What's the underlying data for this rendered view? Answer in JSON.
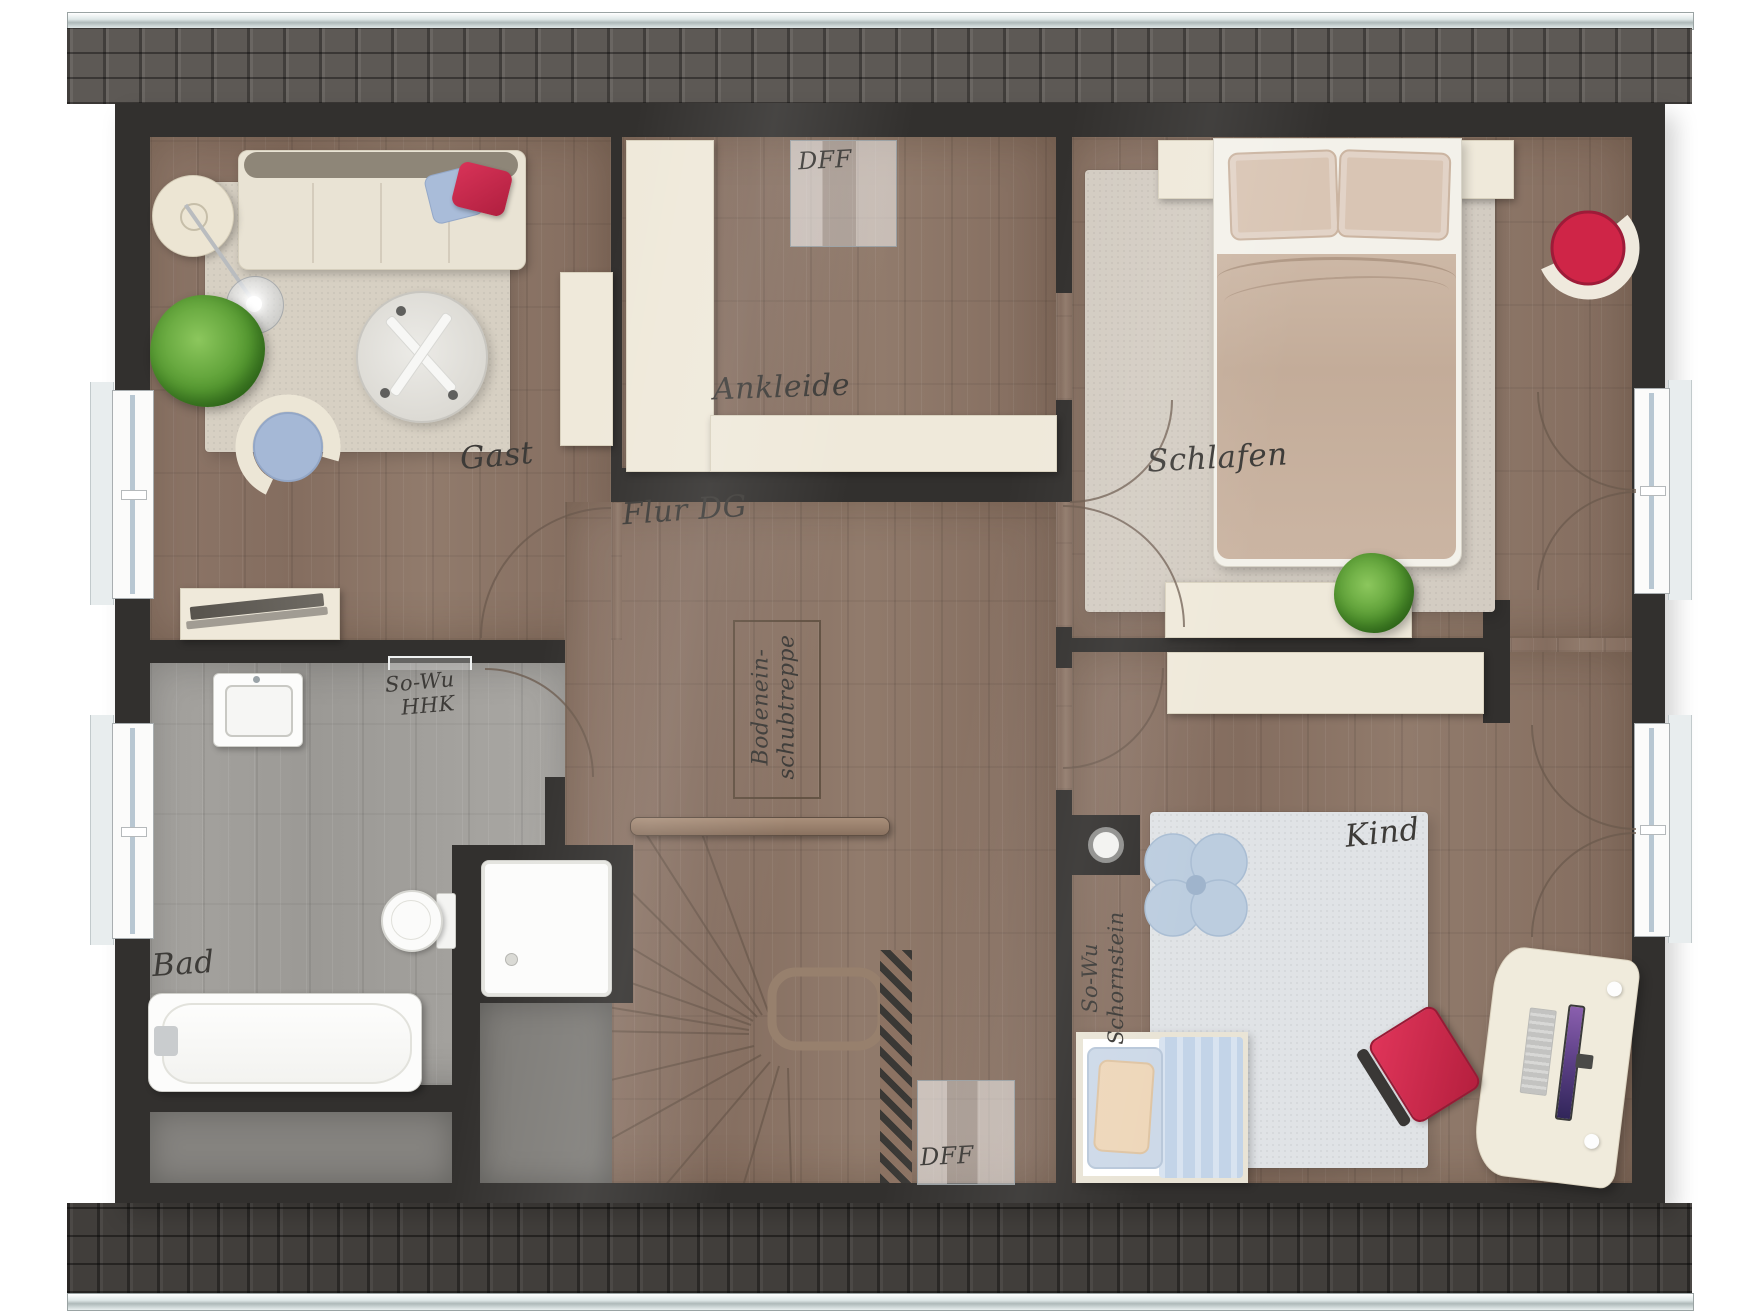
{
  "floorplan": {
    "rooms": [
      {
        "id": "gast",
        "label": "Gast"
      },
      {
        "id": "ankleide",
        "label": "Ankleide"
      },
      {
        "id": "schlafen",
        "label": "Schlafen"
      },
      {
        "id": "bad",
        "label": "Bad"
      },
      {
        "id": "flur-dg",
        "label": "Flur DG"
      },
      {
        "id": "kind",
        "label": "Kind"
      }
    ],
    "annotations": {
      "roof_window_top": "DFF",
      "roof_window_bottom": "DFF",
      "towel_radiator": {
        "line1": "So-Wu",
        "line2": "HHK"
      },
      "loft_ladder": {
        "line1": "Bodenein-",
        "line2": "schubtreppe"
      },
      "chimney": {
        "line1": "So-Wu",
        "line2": "Schornstein"
      }
    },
    "colors": {
      "wall": "#32302e",
      "wood_floor": "#8b7466",
      "bath_floor": "#a3a19d",
      "furniture_cream": "#efe9da",
      "rug_beige": "#d7d0c3",
      "rug_gray": "#d3ccc2",
      "rug_light_blue": "#e0e3e6",
      "accent_red": "#cb2746",
      "pillow_blue": "#a9bcd9",
      "plant_green": "#569a31",
      "roof_band_top": "#5d5955",
      "roof_band_bottom": "#413e3b"
    }
  }
}
